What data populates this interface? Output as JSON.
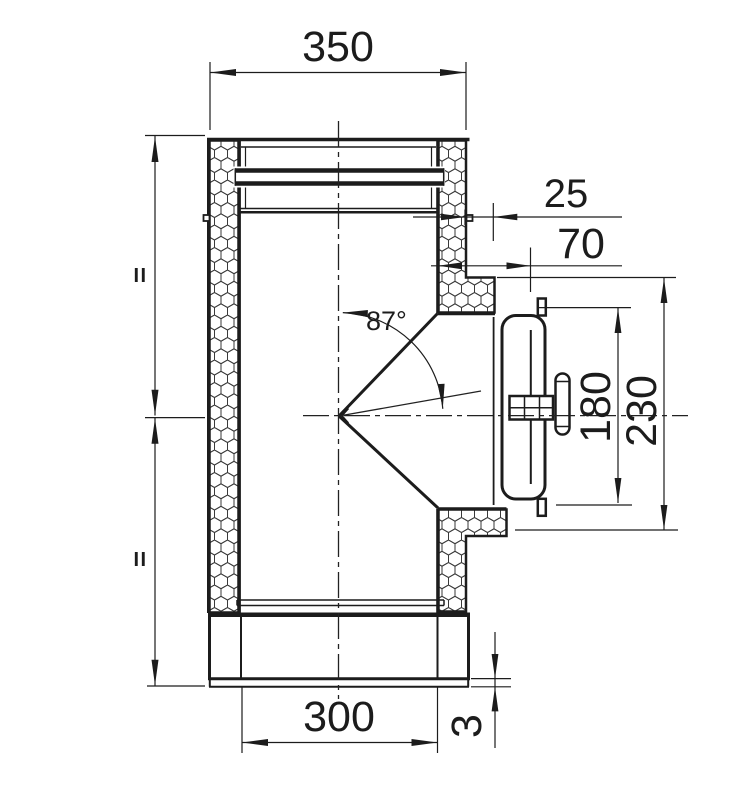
{
  "drawing": {
    "labels": {
      "width_top": "350",
      "insulation_offset": "25",
      "branch_depth": "70",
      "angle": "87°",
      "door_height": "180",
      "branch_height": "230",
      "width_bottom": "300",
      "lip_thickness": "3",
      "equal_upper": "II",
      "equal_lower": "II"
    },
    "colors": {
      "line": "#1c1c1c",
      "background": "#ffffff"
    }
  }
}
